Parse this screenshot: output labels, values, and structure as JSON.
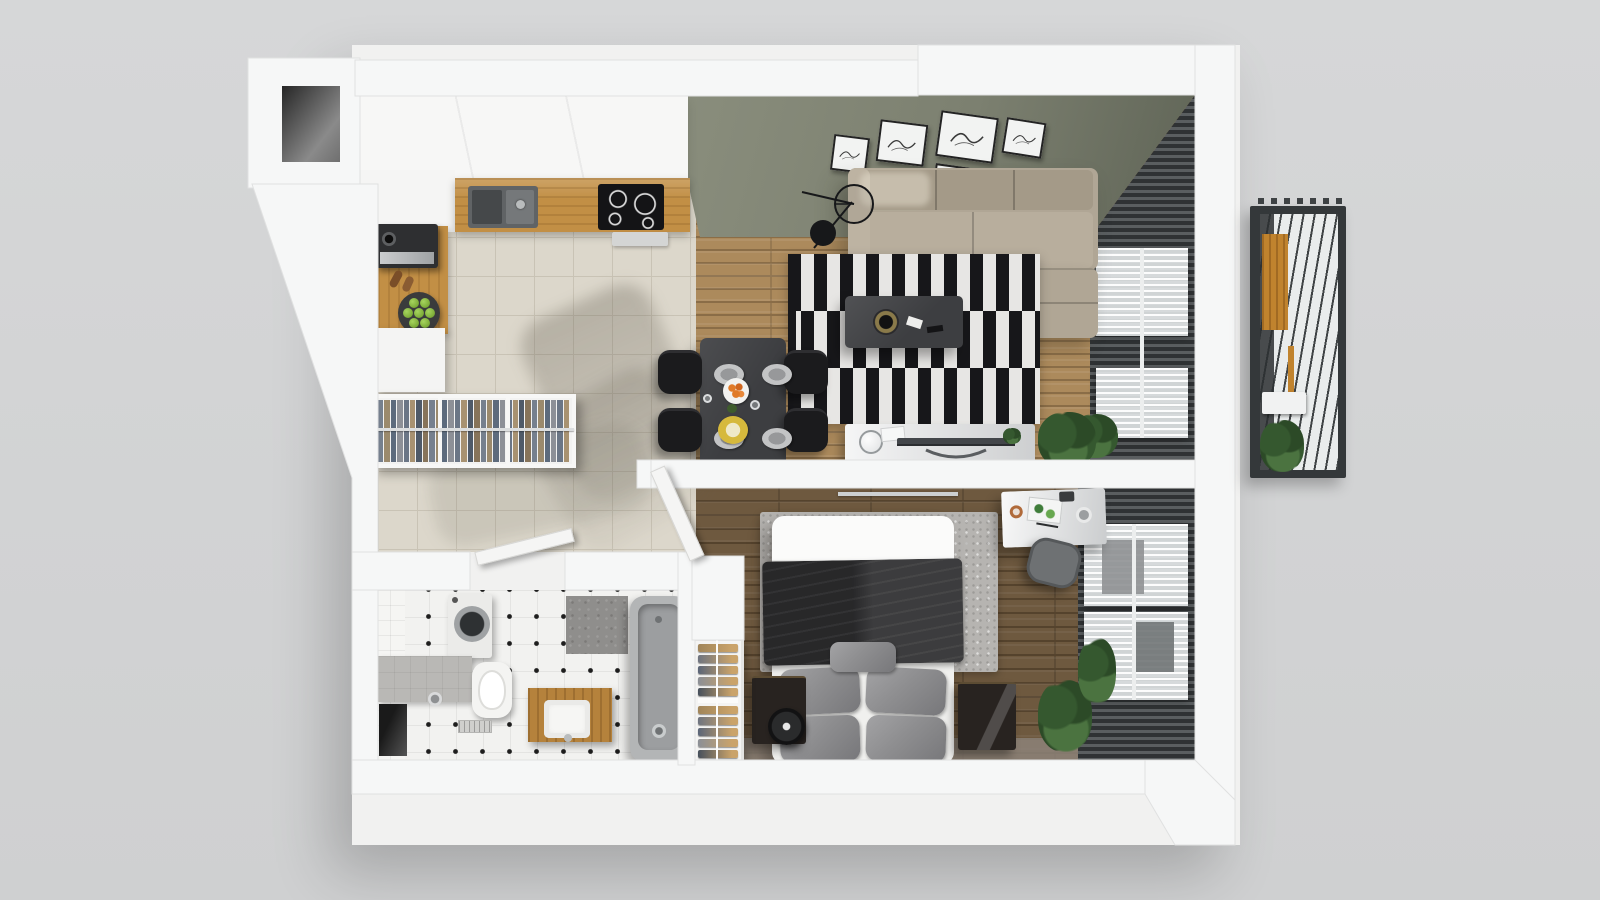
{
  "scene": {
    "title": "apartment-floor-plan-3d-top-view",
    "style": "photorealistic 3d render, top-down, gray studio background",
    "rooms_inventory": {
      "kitchen": [
        "upper-cabinets",
        "oak-countertop",
        "double-sink",
        "induction-cooktop",
        "extractor-vent",
        "coffee-machine",
        "pepper-mills",
        "fruit-plate-limes",
        "white-island"
      ],
      "hallway": [
        "open-wardrobe-hanging-clothes",
        "tiled-floor"
      ],
      "bathroom": [
        "washing-machine",
        "wall-hung-toilet",
        "gray-ledge",
        "wood-vanity-with-sink",
        "bathtub",
        "floor-drain",
        "wall-niche",
        "dotted-tile-floor"
      ],
      "dining": [
        "dark-table",
        "four-black-chairs",
        "tableware"
      ],
      "living_room": [
        "green-accent-wall",
        "five-wall-art-frames",
        "corner-sofa-beige",
        "black-white-striped-rug",
        "dark-coffee-table",
        "tv-sideboard",
        "floor-lamp",
        "potted-plants",
        "window-blinds-with-sheers"
      ],
      "bedroom": [
        "double-bed",
        "black-blanket",
        "gray-pillows",
        "speckled-area-rug",
        "two-dark-nightstands",
        "round-speaker",
        "desk-with-accessories",
        "desk-chair",
        "shoe-rack",
        "window-blinds-with-sheers",
        "plants",
        "open-door"
      ],
      "balcony": [
        "pergola-slats",
        "orange-wood-panel",
        "white-bench",
        "plant"
      ]
    }
  },
  "palette": {
    "bg": "#d3d4d5",
    "wall": "#f6f7f7",
    "wallEdge": "#e0e1e1",
    "tile": "#dcd7cb",
    "tileLine": "#c9c3b5",
    "woodLiving": "#ac8a5c",
    "woodLivingGap": "#8a6d47",
    "woodBed": "#6e593f",
    "woodBedGap": "#55432d",
    "greenWall1": "#8a8e7d",
    "greenWall2": "#5f6456",
    "blindsDark": "#2f3234",
    "blindsLight": "#5a5e60",
    "sheer": "rgba(244,246,247,0.80)",
    "sofa": "#b0a695",
    "sofaBack": "#a49a88",
    "sofaSeat": "#b8ae9d",
    "rugBlack": "#17171a",
    "rugWhite": "#e7e6e4",
    "tableDark": "#3d3e41",
    "chairBlack": "#1b1b1d",
    "counterWood": "#c28f45",
    "vanityWood": "#b5823c",
    "balconyWood": "#c0832e",
    "bedWhite": "#f0f0ee",
    "blanket": "#1c1c1e",
    "pillow": "#8e8e90",
    "bedRug": "#b6b4b1",
    "nightstand": "#282320",
    "deskWhite": "#dddedf",
    "plantDark": "#2c4a27",
    "plantMid": "#35582f",
    "plantLight": "#4b7340",
    "tub": "#b3b5b6",
    "tubInner": "#9c9ea0",
    "concrete": "#8f8e8c",
    "ledge": "#b9b8b5",
    "bathTile": "#f2f2f0",
    "bathDot": "#1e1e1e",
    "grayFloor": "#8d8379",
    "frameWhite": "#f2f3f2",
    "frameBorder": "#232323",
    "lime": "#7fae3a",
    "orange": "#e07a28",
    "yellowPlate": "#d6b93c",
    "gold": "#b99a4e",
    "balconyFrame": "#34383a",
    "balconyFloor": "#e9ecec",
    "balconySlat": "#3f4345"
  },
  "living_room": {
    "wall_frames": [
      {
        "x": 832,
        "y": 136,
        "w": 36,
        "h": 36,
        "rot": 7
      },
      {
        "x": 878,
        "y": 122,
        "w": 48,
        "h": 42,
        "rot": 7
      },
      {
        "x": 938,
        "y": 114,
        "w": 58,
        "h": 46,
        "rot": 8
      },
      {
        "x": 1004,
        "y": 120,
        "w": 40,
        "h": 36,
        "rot": 9
      },
      {
        "x": 934,
        "y": 166,
        "w": 44,
        "h": 24,
        "rot": 8
      }
    ]
  },
  "hallway": {
    "wardrobe": {
      "strip_count": 30,
      "clothes_colors": [
        "#76808e",
        "#9b8a6d",
        "#5d6b7d",
        "#8d9097",
        "#6b7686",
        "#a89271",
        "#4f5a68",
        "#87745a"
      ]
    }
  },
  "bedroom": {
    "shoe_rack": {
      "stacks": 2,
      "rows_per_stack": 5,
      "shelf_colors": [
        "#a0855a",
        "#6e7480",
        "#5a6578",
        "#8b8f96",
        "#46505c"
      ]
    }
  },
  "kitchen": {
    "fruit_plate": {
      "fruit": "limes",
      "count": 7
    }
  },
  "dining": {
    "plates": [
      {
        "x": 714,
        "y": 364
      },
      {
        "x": 762,
        "y": 364
      },
      {
        "x": 714,
        "y": 428
      },
      {
        "x": 762,
        "y": 428
      }
    ],
    "chair_positions": [
      {
        "x": 658,
        "y": 350
      },
      {
        "x": 658,
        "y": 408
      },
      {
        "x": 784,
        "y": 350
      },
      {
        "x": 784,
        "y": 408
      }
    ]
  },
  "balcony": {
    "teeth_count": 7
  }
}
